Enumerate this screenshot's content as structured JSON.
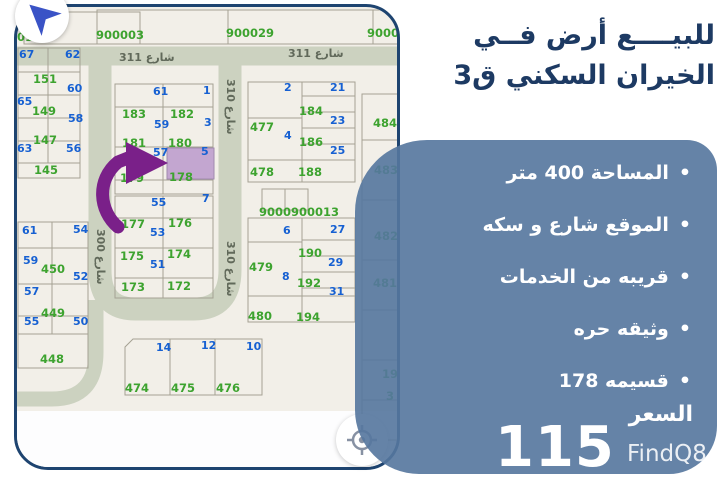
{
  "title": {
    "line1": "للبيــــع أرض فــي",
    "line2": "الخيران السكني ق3"
  },
  "panel": {
    "bullets": [
      "المساحة 400 متر",
      "الموقع شارع و سكه",
      "قريبه من الخدمات",
      "وثيقه حره",
      "قسيمه 178"
    ],
    "price_label": "السعر",
    "price_value": "115"
  },
  "watermark": "FindQ8",
  "colors": {
    "panel": "#56779e",
    "title": "#1d3a63",
    "arrow": "#7a2089",
    "highlight": "#c3a6d0",
    "map_border": "#1e4470",
    "street": "#ccd2c0",
    "blue_label": "#1660d2",
    "green_label": "#3da32f"
  },
  "map": {
    "street_labels": [
      {
        "t": "شارع 311",
        "x": 102,
        "y": 44,
        "v": false
      },
      {
        "t": "شارع 311",
        "x": 271,
        "y": 40,
        "v": false
      },
      {
        "t": "شارع 310",
        "x": 220,
        "y": 72,
        "v": true
      },
      {
        "t": "شارع 310",
        "x": 220,
        "y": 234,
        "v": true
      },
      {
        "t": "شارع 300",
        "x": 90,
        "y": 222,
        "v": true
      }
    ],
    "labels": [
      {
        "t": "0190",
        "x": 0,
        "y": 24,
        "c": "g"
      },
      {
        "t": "900003",
        "x": 79,
        "y": 22,
        "c": "g"
      },
      {
        "t": "900029",
        "x": 209,
        "y": 20,
        "c": "g"
      },
      {
        "t": "90002",
        "x": 350,
        "y": 20,
        "c": "g"
      },
      {
        "t": "67",
        "x": 2,
        "y": 42,
        "c": "b"
      },
      {
        "t": "62",
        "x": 48,
        "y": 42,
        "c": "b"
      },
      {
        "t": "151",
        "x": 16,
        "y": 66,
        "c": "g"
      },
      {
        "t": "65",
        "x": 0,
        "y": 89,
        "c": "b"
      },
      {
        "t": "60",
        "x": 50,
        "y": 76,
        "c": "b"
      },
      {
        "t": "149",
        "x": 15,
        "y": 98,
        "c": "g"
      },
      {
        "t": "58",
        "x": 51,
        "y": 106,
        "c": "b"
      },
      {
        "t": "147",
        "x": 16,
        "y": 127,
        "c": "g"
      },
      {
        "t": "63",
        "x": 0,
        "y": 136,
        "c": "b"
      },
      {
        "t": "56",
        "x": 49,
        "y": 136,
        "c": "b"
      },
      {
        "t": "145",
        "x": 17,
        "y": 157,
        "c": "g"
      },
      {
        "t": "61",
        "x": 136,
        "y": 79,
        "c": "b"
      },
      {
        "t": "1",
        "x": 186,
        "y": 78,
        "c": "b"
      },
      {
        "t": "183",
        "x": 105,
        "y": 101,
        "c": "g"
      },
      {
        "t": "182",
        "x": 153,
        "y": 101,
        "c": "g"
      },
      {
        "t": "59",
        "x": 137,
        "y": 112,
        "c": "b"
      },
      {
        "t": "3",
        "x": 187,
        "y": 110,
        "c": "b"
      },
      {
        "t": "181",
        "x": 105,
        "y": 130,
        "c": "g"
      },
      {
        "t": "180",
        "x": 151,
        "y": 130,
        "c": "g"
      },
      {
        "t": "57",
        "x": 136,
        "y": 140,
        "c": "b"
      },
      {
        "t": "5",
        "x": 184,
        "y": 139,
        "c": "b"
      },
      {
        "t": "179",
        "x": 103,
        "y": 165,
        "c": "g"
      },
      {
        "t": "178",
        "x": 152,
        "y": 164,
        "c": "g"
      },
      {
        "t": "55",
        "x": 134,
        "y": 190,
        "c": "b"
      },
      {
        "t": "7",
        "x": 185,
        "y": 186,
        "c": "b"
      },
      {
        "t": "177",
        "x": 104,
        "y": 211,
        "c": "g"
      },
      {
        "t": "176",
        "x": 151,
        "y": 210,
        "c": "g"
      },
      {
        "t": "53",
        "x": 133,
        "y": 220,
        "c": "b"
      },
      {
        "t": "175",
        "x": 103,
        "y": 243,
        "c": "g"
      },
      {
        "t": "174",
        "x": 150,
        "y": 241,
        "c": "g"
      },
      {
        "t": "51",
        "x": 133,
        "y": 252,
        "c": "b"
      },
      {
        "t": "173",
        "x": 104,
        "y": 274,
        "c": "g"
      },
      {
        "t": "172",
        "x": 150,
        "y": 273,
        "c": "g"
      },
      {
        "t": "61",
        "x": 5,
        "y": 218,
        "c": "b"
      },
      {
        "t": "54",
        "x": 56,
        "y": 217,
        "c": "b"
      },
      {
        "t": "59",
        "x": 6,
        "y": 248,
        "c": "b"
      },
      {
        "t": "450",
        "x": 24,
        "y": 256,
        "c": "g"
      },
      {
        "t": "52",
        "x": 56,
        "y": 264,
        "c": "b"
      },
      {
        "t": "57",
        "x": 7,
        "y": 279,
        "c": "b"
      },
      {
        "t": "449",
        "x": 24,
        "y": 300,
        "c": "g"
      },
      {
        "t": "55",
        "x": 7,
        "y": 309,
        "c": "b"
      },
      {
        "t": "50",
        "x": 56,
        "y": 309,
        "c": "b"
      },
      {
        "t": "448",
        "x": 23,
        "y": 346,
        "c": "g"
      },
      {
        "t": "2",
        "x": 267,
        "y": 75,
        "c": "b"
      },
      {
        "t": "21",
        "x": 313,
        "y": 75,
        "c": "b"
      },
      {
        "t": "184",
        "x": 282,
        "y": 98,
        "c": "g"
      },
      {
        "t": "23",
        "x": 313,
        "y": 108,
        "c": "b"
      },
      {
        "t": "477",
        "x": 233,
        "y": 114,
        "c": "g"
      },
      {
        "t": "4",
        "x": 267,
        "y": 123,
        "c": "b"
      },
      {
        "t": "186",
        "x": 282,
        "y": 129,
        "c": "g"
      },
      {
        "t": "25",
        "x": 313,
        "y": 138,
        "c": "b"
      },
      {
        "t": "478",
        "x": 233,
        "y": 159,
        "c": "g"
      },
      {
        "t": "188",
        "x": 281,
        "y": 159,
        "c": "g"
      },
      {
        "t": "9000900013",
        "x": 242,
        "y": 199,
        "c": "g"
      },
      {
        "t": "6",
        "x": 266,
        "y": 218,
        "c": "b"
      },
      {
        "t": "27",
        "x": 313,
        "y": 217,
        "c": "b"
      },
      {
        "t": "190",
        "x": 281,
        "y": 240,
        "c": "g"
      },
      {
        "t": "29",
        "x": 311,
        "y": 250,
        "c": "b"
      },
      {
        "t": "479",
        "x": 232,
        "y": 254,
        "c": "g"
      },
      {
        "t": "8",
        "x": 265,
        "y": 264,
        "c": "b"
      },
      {
        "t": "192",
        "x": 280,
        "y": 270,
        "c": "g"
      },
      {
        "t": "31",
        "x": 312,
        "y": 279,
        "c": "b"
      },
      {
        "t": "480",
        "x": 231,
        "y": 303,
        "c": "g"
      },
      {
        "t": "194",
        "x": 279,
        "y": 304,
        "c": "g"
      },
      {
        "t": "14",
        "x": 139,
        "y": 335,
        "c": "b"
      },
      {
        "t": "12",
        "x": 184,
        "y": 333,
        "c": "b"
      },
      {
        "t": "10",
        "x": 229,
        "y": 334,
        "c": "b"
      },
      {
        "t": "474",
        "x": 108,
        "y": 375,
        "c": "g"
      },
      {
        "t": "475",
        "x": 154,
        "y": 375,
        "c": "g"
      },
      {
        "t": "476",
        "x": 199,
        "y": 375,
        "c": "g"
      },
      {
        "t": "484",
        "x": 356,
        "y": 110,
        "c": "g"
      },
      {
        "t": "483",
        "x": 357,
        "y": 157,
        "c": "g"
      },
      {
        "t": "482",
        "x": 357,
        "y": 223,
        "c": "g"
      },
      {
        "t": "481",
        "x": 356,
        "y": 270,
        "c": "g"
      },
      {
        "t": "196",
        "x": 365,
        "y": 361,
        "c": "g"
      },
      {
        "t": "3",
        "x": 369,
        "y": 383,
        "c": "g"
      }
    ]
  }
}
